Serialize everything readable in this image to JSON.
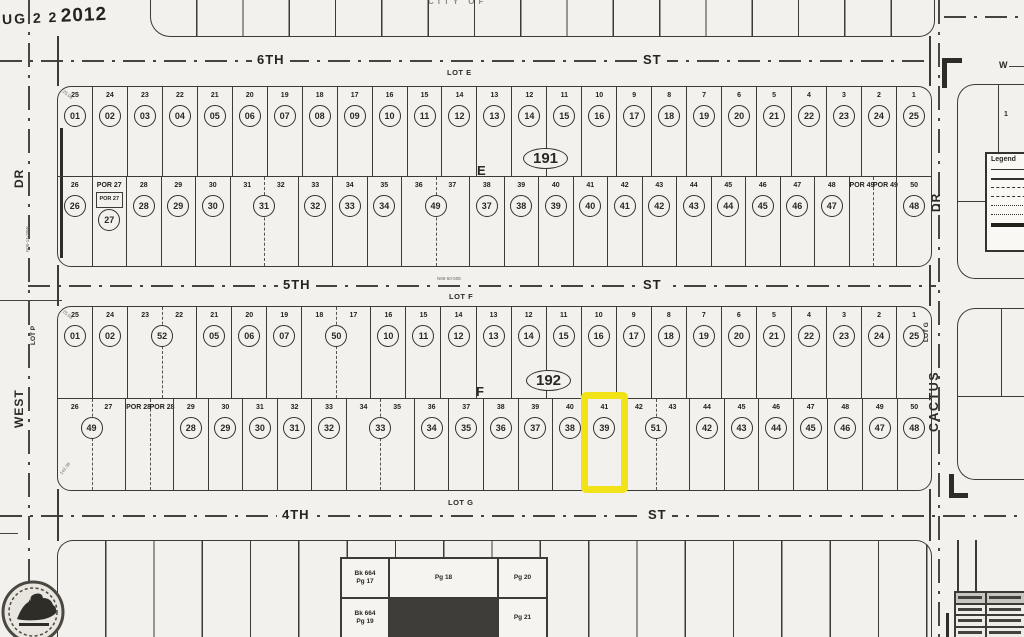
{
  "stamp": {
    "part1": "UG 2 2",
    "part2": "2012"
  },
  "city_text": "CITY OF",
  "streets": {
    "s6": {
      "name": "6TH",
      "suffix": "ST"
    },
    "s5": {
      "name": "5TH",
      "suffix": "ST"
    },
    "s4": {
      "name": "4TH",
      "suffix": "ST"
    }
  },
  "lot_labels": {
    "e": "LOT E",
    "f": "LOT F",
    "g": "LOT G"
  },
  "bearing_5th": "N89-50-50E",
  "west_road": {
    "dr": "DR",
    "name": "WEST",
    "lot": "LOT P",
    "bearing": "N00-14-20W"
  },
  "east_road": {
    "dr": "DR",
    "name": "CACTUS",
    "lot": "LOT G",
    "lot1": "1"
  },
  "compass_w": "W",
  "legend": {
    "title": "Legend"
  },
  "corner_dims": [
    "25.08",
    "25.08",
    "142.38"
  ],
  "page_index": {
    "cells": [
      "Bk 664\nPg 17",
      "Pg 18",
      "Pg 20",
      "Bk 664\nPg 19",
      "",
      "Pg 21"
    ]
  },
  "highlight_color": "#f2e318",
  "blocks": {
    "b191": {
      "number": "191",
      "letter": "E",
      "row_top": [
        {
          "labels": [
            "25"
          ],
          "circ": "01"
        },
        {
          "labels": [
            "24"
          ],
          "circ": "02"
        },
        {
          "labels": [
            "23"
          ],
          "circ": "03"
        },
        {
          "labels": [
            "22"
          ],
          "circ": "04"
        },
        {
          "labels": [
            "21"
          ],
          "circ": "05"
        },
        {
          "labels": [
            "20"
          ],
          "circ": "06"
        },
        {
          "labels": [
            "19"
          ],
          "circ": "07"
        },
        {
          "labels": [
            "18"
          ],
          "circ": "08"
        },
        {
          "labels": [
            "17"
          ],
          "circ": "09"
        },
        {
          "labels": [
            "16"
          ],
          "circ": "10"
        },
        {
          "labels": [
            "15"
          ],
          "circ": "11"
        },
        {
          "labels": [
            "14"
          ],
          "circ": "12"
        },
        {
          "labels": [
            "13"
          ],
          "circ": "13"
        },
        {
          "labels": [
            "12"
          ],
          "circ": "14"
        },
        {
          "labels": [
            "11"
          ],
          "circ": "15"
        },
        {
          "labels": [
            "10"
          ],
          "circ": "16"
        },
        {
          "labels": [
            "9"
          ],
          "circ": "17"
        },
        {
          "labels": [
            "8"
          ],
          "circ": "18"
        },
        {
          "labels": [
            "7"
          ],
          "circ": "19"
        },
        {
          "labels": [
            "6"
          ],
          "circ": "20"
        },
        {
          "labels": [
            "5"
          ],
          "circ": "21"
        },
        {
          "labels": [
            "4"
          ],
          "circ": "22"
        },
        {
          "labels": [
            "3"
          ],
          "circ": "23"
        },
        {
          "labels": [
            "2"
          ],
          "circ": "24"
        },
        {
          "labels": [
            "1"
          ],
          "circ": "25"
        }
      ],
      "row_bottom": [
        {
          "labels": [
            "26"
          ],
          "circ": "26"
        },
        {
          "labels": [
            "POR 27"
          ],
          "circ": "27",
          "por": true,
          "por_inner": "POR 27"
        },
        {
          "labels": [
            "28"
          ],
          "circ": "28"
        },
        {
          "labels": [
            "29"
          ],
          "circ": "29"
        },
        {
          "labels": [
            "30"
          ],
          "circ": "30"
        },
        {
          "labels": [
            "31",
            "32"
          ],
          "circ": "31",
          "span": 2,
          "dashed": true
        },
        {
          "labels": [
            "33"
          ],
          "circ": "32"
        },
        {
          "labels": [
            "34"
          ],
          "circ": "33"
        },
        {
          "labels": [
            "35"
          ],
          "circ": "34"
        },
        {
          "labels": [
            "36",
            "37"
          ],
          "circ": "49",
          "span": 2,
          "dashed": true
        },
        {
          "labels": [
            "38"
          ],
          "circ": "37"
        },
        {
          "labels": [
            "39"
          ],
          "circ": "38"
        },
        {
          "labels": [
            "40"
          ],
          "circ": "39"
        },
        {
          "labels": [
            "41"
          ],
          "circ": "40"
        },
        {
          "labels": [
            "42"
          ],
          "circ": "41"
        },
        {
          "labels": [
            "43"
          ],
          "circ": "42"
        },
        {
          "labels": [
            "44"
          ],
          "circ": "43"
        },
        {
          "labels": [
            "45"
          ],
          "circ": "44"
        },
        {
          "labels": [
            "46"
          ],
          "circ": "45"
        },
        {
          "labels": [
            "47"
          ],
          "circ": "46"
        },
        {
          "labels": [
            "48"
          ],
          "circ": "47"
        },
        {
          "labels": [
            "POR 49",
            "POR 49"
          ],
          "span": 1.4,
          "dashed": true
        },
        {
          "labels": [
            "50"
          ],
          "circ": "48"
        }
      ]
    },
    "b192": {
      "number": "192",
      "letter": "F",
      "row_top": [
        {
          "labels": [
            "25"
          ],
          "circ": "01"
        },
        {
          "labels": [
            "24"
          ],
          "circ": "02"
        },
        {
          "labels": [
            "23",
            "22"
          ],
          "circ": "52",
          "span": 2,
          "dashed": true
        },
        {
          "labels": [
            "21"
          ],
          "circ": "05"
        },
        {
          "labels": [
            "20"
          ],
          "circ": "06"
        },
        {
          "labels": [
            "19"
          ],
          "circ": "07"
        },
        {
          "labels": [
            "18",
            "17"
          ],
          "circ": "50",
          "span": 2,
          "dashed": true
        },
        {
          "labels": [
            "16"
          ],
          "circ": "10"
        },
        {
          "labels": [
            "15"
          ],
          "circ": "11"
        },
        {
          "labels": [
            "14"
          ],
          "circ": "12"
        },
        {
          "labels": [
            "13"
          ],
          "circ": "13"
        },
        {
          "labels": [
            "12"
          ],
          "circ": "14"
        },
        {
          "labels": [
            "11"
          ],
          "circ": "15"
        },
        {
          "labels": [
            "10"
          ],
          "circ": "16"
        },
        {
          "labels": [
            "9"
          ],
          "circ": "17"
        },
        {
          "labels": [
            "8"
          ],
          "circ": "18"
        },
        {
          "labels": [
            "7"
          ],
          "circ": "19"
        },
        {
          "labels": [
            "6"
          ],
          "circ": "20"
        },
        {
          "labels": [
            "5"
          ],
          "circ": "21"
        },
        {
          "labels": [
            "4"
          ],
          "circ": "22"
        },
        {
          "labels": [
            "3"
          ],
          "circ": "23"
        },
        {
          "labels": [
            "2"
          ],
          "circ": "24"
        },
        {
          "labels": [
            "1"
          ],
          "circ": "25"
        }
      ],
      "row_bottom": [
        {
          "labels": [
            "26",
            "27"
          ],
          "circ": "49",
          "span": 2,
          "dashed": true
        },
        {
          "labels": [
            "POR 28",
            "POR 28"
          ],
          "span": 1.4,
          "dashed": true
        },
        {
          "labels": [
            "29"
          ],
          "circ": "28"
        },
        {
          "labels": [
            "30"
          ],
          "circ": "29"
        },
        {
          "labels": [
            "31"
          ],
          "circ": "30"
        },
        {
          "labels": [
            "32"
          ],
          "circ": "31"
        },
        {
          "labels": [
            "33"
          ],
          "circ": "32"
        },
        {
          "labels": [
            "34",
            "35"
          ],
          "circ": "33",
          "span": 2,
          "dashed": true
        },
        {
          "labels": [
            "36"
          ],
          "circ": "34"
        },
        {
          "labels": [
            "37"
          ],
          "circ": "35"
        },
        {
          "labels": [
            "38"
          ],
          "circ": "36"
        },
        {
          "labels": [
            "39"
          ],
          "circ": "37"
        },
        {
          "labels": [
            "40"
          ],
          "circ": "38"
        },
        {
          "labels": [
            "41"
          ],
          "circ": "39",
          "hl": true
        },
        {
          "labels": [
            "42",
            "43"
          ],
          "circ": "51",
          "span": 2,
          "dashed": true
        },
        {
          "labels": [
            "44"
          ],
          "circ": "42"
        },
        {
          "labels": [
            "45"
          ],
          "circ": "43"
        },
        {
          "labels": [
            "46"
          ],
          "circ": "44"
        },
        {
          "labels": [
            "47"
          ],
          "circ": "45"
        },
        {
          "labels": [
            "48"
          ],
          "circ": "46"
        },
        {
          "labels": [
            "49"
          ],
          "circ": "47"
        },
        {
          "labels": [
            "50"
          ],
          "circ": "48"
        }
      ]
    }
  }
}
